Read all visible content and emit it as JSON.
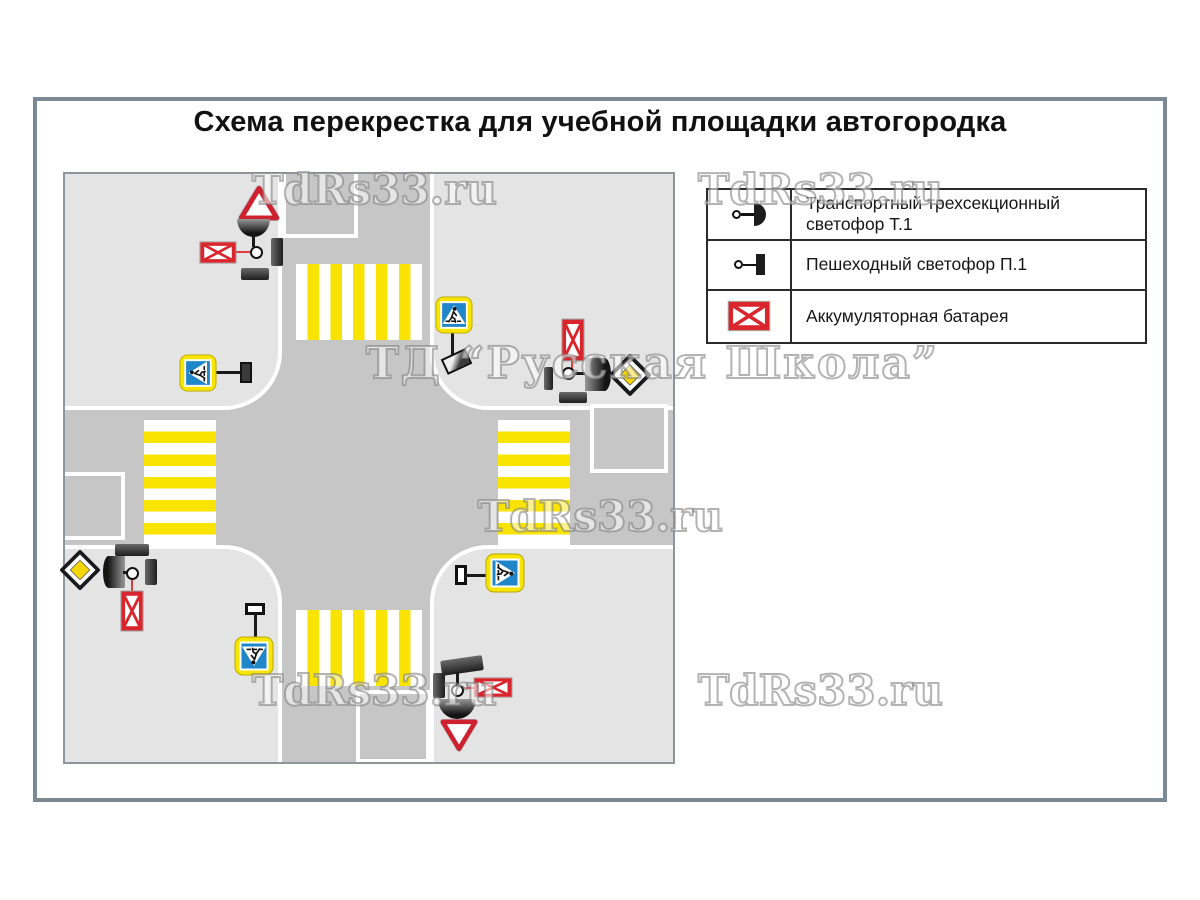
{
  "page": {
    "title": "Схема перекрестка для учебной площадки автогородка"
  },
  "legend": {
    "rows": [
      {
        "icon": "t1-traffic-light-icon",
        "label": "Транспортный  трехсекционный\nсветофор Т.1"
      },
      {
        "icon": "p1-pedestrian-light-icon",
        "label": "Пешеходный светофор П.1"
      },
      {
        "icon": "battery-icon",
        "label": "Аккумуляторная батарея"
      }
    ]
  },
  "watermarks": {
    "site": "TdRs33.ru",
    "brand": "ТД “Русская Школа”"
  },
  "map": {
    "icons": [
      "give-way-sign-icon",
      "main-road-sign-icon",
      "pedestrian-crossing-sign-icon",
      "t1-traffic-light-icon",
      "p1-pedestrian-light-icon",
      "battery-icon",
      "crosswalk-zebra"
    ]
  },
  "colors": {
    "frame": "#7b8994",
    "map-border": "#8f969b",
    "road": "#c6c6c6",
    "block": "#e4e4e4",
    "stripe-yellow": "#f9e300",
    "sign-yellow": "#f7e400",
    "sign-blue": "#1f86c9",
    "sign-red": "#cf2030",
    "battery-red": "#d8262c",
    "diamond-yellow": "#f3d602"
  }
}
